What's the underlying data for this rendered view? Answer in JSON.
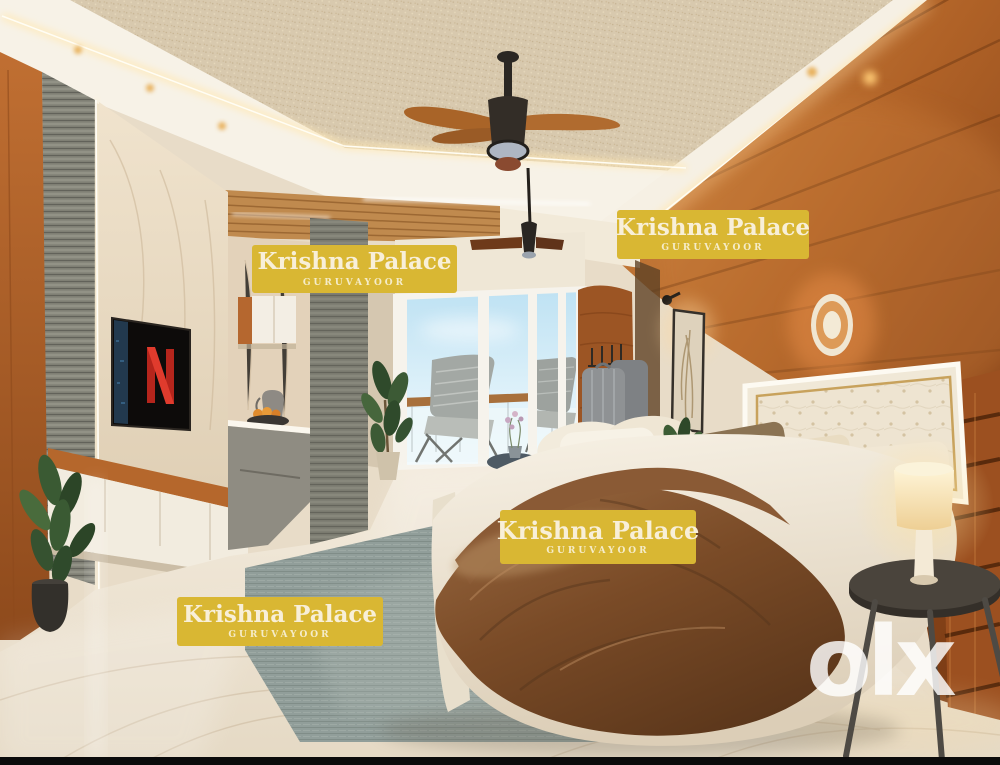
{
  "watermarks": [
    {
      "title": "Krishna Palace",
      "subtitle": "GURUVAYOOR"
    },
    {
      "title": "Krishna Palace",
      "subtitle": "GURUVAYOOR"
    },
    {
      "title": "Krishna Palace",
      "subtitle": "GURUVAYOOR"
    },
    {
      "title": "Krishna Palace",
      "subtitle": "GURUVAYOOR"
    }
  ],
  "logo": {
    "text": "olx"
  },
  "tv": {
    "screen_logo": "N"
  },
  "colors": {
    "watermark_bg": "#d9b733",
    "watermark_text": "#f8efd8",
    "logo_text": "#ffffff",
    "netflix_red": "#d5291f",
    "wood_wall": "#a4571f",
    "rug": "#9aa7a4",
    "blanket": "#7a4b27",
    "ceiling": "#d8c9ae",
    "floor": "#efe6d6"
  }
}
